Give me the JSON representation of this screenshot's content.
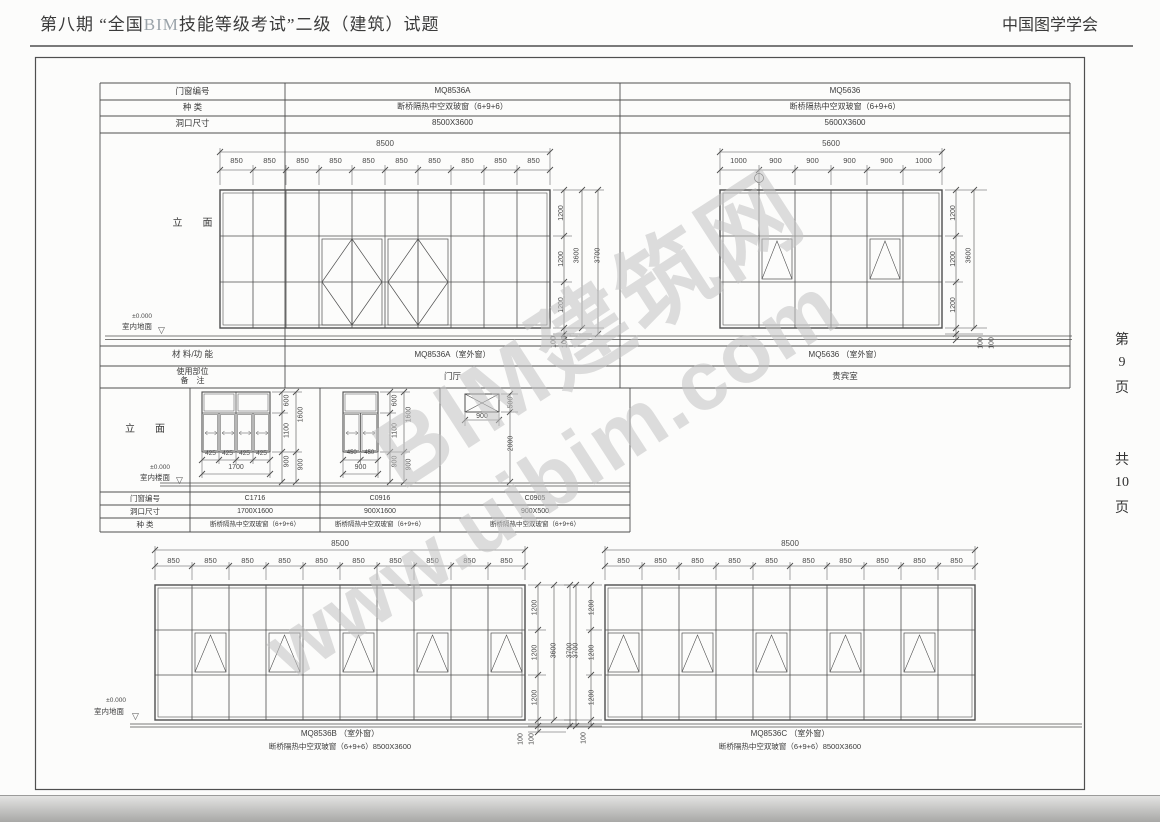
{
  "header": {
    "title_pre": "第八期 “全国",
    "title_bim": "BIM",
    "title_post": "技能等级考试”二级（建筑）试题",
    "org": "中国图学学会"
  },
  "margin": {
    "page_chars": [
      "第",
      "9",
      "页"
    ],
    "total_chars": [
      "共",
      "10",
      "页"
    ]
  },
  "watermark": {
    "line1": "BIM建筑网",
    "line2": "www.uibim.com"
  },
  "icons": {
    "level": "▽"
  },
  "schedule_top": {
    "labels": [
      "门窗编号",
      "种    类",
      "洞口尺寸"
    ],
    "a": {
      "code": "MQ8536A",
      "kind": "断桥隔热中空双玻窗（6+9+6）",
      "size": "8500X3600"
    },
    "b": {
      "code": "MQ5636",
      "kind": "断桥隔热中空双玻窗（6+9+6）",
      "size": "5600X3600"
    }
  },
  "band1": {
    "view_label": "立　　面",
    "material_label": "材 料/功 能",
    "part_label": "使用部位",
    "note_label": "备　注",
    "level": "±0.000",
    "floor": "室内地面",
    "a": {
      "total": "8500",
      "segs": [
        "850",
        "850",
        "850",
        "850",
        "850",
        "850",
        "850",
        "850",
        "850",
        "850"
      ],
      "rows": [
        "1200",
        "1200",
        "1200"
      ],
      "sub": "3600",
      "overall": "3700",
      "below": [
        "100",
        "100"
      ],
      "name": "MQ8536A（室外窗）",
      "usage": "门厅"
    },
    "b": {
      "total": "5600",
      "segs": [
        "1000",
        "900",
        "900",
        "900",
        "900",
        "1000"
      ],
      "rows": [
        "1200",
        "1200",
        "1200"
      ],
      "sub": "3600",
      "below": [
        "100",
        "100"
      ],
      "name": "MQ5636 （室外窗）",
      "usage": "贵宾室"
    }
  },
  "band2": {
    "view_label": "立　　面",
    "labels": [
      "门窗编号",
      "洞口尺寸",
      "种    类"
    ],
    "level": "±0.000",
    "floor": "室内楼面",
    "w1": {
      "code": "C1716",
      "size": "1700X1600",
      "kind": "断桥隔热中空双玻窗（6+9+6）",
      "segs": [
        "425",
        "425",
        "425",
        "425"
      ],
      "total": "1700",
      "vtop": "600",
      "vbot": "1100",
      "vtotal": "1600",
      "sill": "900",
      "sill2": "900"
    },
    "w2": {
      "code": "C0916",
      "size": "900X1600",
      "kind": "断桥隔热中空双玻窗（6+9+6）",
      "segs": [
        "450",
        "450"
      ],
      "total": "900",
      "vtop": "600",
      "vbot": "1100",
      "vtotal": "1600",
      "sill": "900",
      "sill2": "900"
    },
    "w3": {
      "code": "C0905",
      "size": "900X500",
      "kind": "断桥隔热中空双玻窗（6+9+6）",
      "width": "900",
      "height": "500",
      "sill": "2000"
    }
  },
  "band3": {
    "level": "±0.000",
    "floor": "室内地面",
    "c": {
      "total": "8500",
      "segs": [
        "850",
        "850",
        "850",
        "850",
        "850",
        "850",
        "850",
        "850",
        "850",
        "850"
      ],
      "rows": [
        "1200",
        "1200",
        "1200"
      ],
      "sub": "3600",
      "overall": "3700",
      "below": [
        "100",
        "100"
      ],
      "name": "MQ8536B （室外窗）",
      "desc": "断桥隔热中空双玻窗（6+9+6）8500X3600"
    },
    "d": {
      "total": "8500",
      "segs": [
        "850",
        "850",
        "850",
        "850",
        "850",
        "850",
        "850",
        "850",
        "850",
        "850"
      ],
      "rows": [
        "1200",
        "1200",
        "1200"
      ],
      "overall": "3700",
      "below": [
        "100"
      ],
      "name": "MQ8536C （室外窗）",
      "desc": "断桥隔热中空双玻窗（6+9+6）8500X3600"
    }
  }
}
